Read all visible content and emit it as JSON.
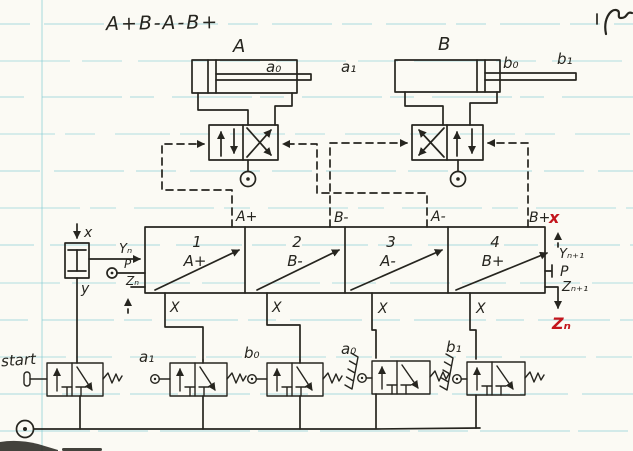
{
  "title": {
    "sequence": "A+B-A-B+"
  },
  "cylinder_a": {
    "label": "A",
    "sensor0": "a₀",
    "sensor1": "a₁"
  },
  "cylinder_b": {
    "label": "B",
    "sensor0": "b₀",
    "sensor1": "b₁"
  },
  "stepper": {
    "cells": [
      {
        "num": "1",
        "action": "A+"
      },
      {
        "num": "2",
        "action": "B-"
      },
      {
        "num": "3",
        "action": "A-"
      },
      {
        "num": "4",
        "action": "B+"
      }
    ],
    "top_ports": [
      "A+",
      "B-",
      "A-",
      "B+"
    ],
    "x_label": "X",
    "left_ports": {
      "yn": "Yₙ",
      "p": "P",
      "zn": "Zₙ"
    },
    "right_ports": {
      "yn1": "Yₙ₊₁",
      "p": "P",
      "zn1": "Zₙ₊₁"
    }
  },
  "aux_valve": {
    "x": "x",
    "y": "y"
  },
  "bottom_valves": [
    {
      "label": "start"
    },
    {
      "label": "a₁"
    },
    {
      "label": "b₀"
    },
    {
      "label": "a₀"
    },
    {
      "label": "b₁"
    }
  ],
  "red_notes": {
    "x": "x",
    "zn": "Zₙ"
  },
  "colors": {
    "ink": "#26251f",
    "red": "#c3151c",
    "rule": "#7bc9d2",
    "paper": "#fbfaf4"
  }
}
